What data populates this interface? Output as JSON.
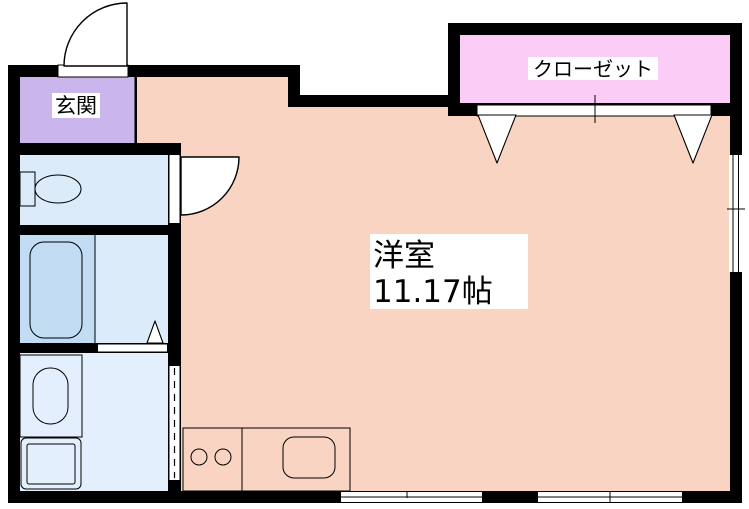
{
  "rooms": {
    "main": {
      "name_label": "洋室",
      "size_label": "11.17帖"
    },
    "entrance": {
      "label": "玄関"
    },
    "closet": {
      "label": "クローゼット"
    }
  },
  "colors": {
    "background": "#ffffff",
    "wall": "#000000",
    "main_room": "#f9d4c3",
    "entrance": "#cab5ec",
    "closet": "#fbcdf6",
    "wet_room": "#dcebfa",
    "wet_room_light": "#e3effc",
    "fixture_zone": "#c2dcf4",
    "fixture_cyan": "#b4eef6",
    "burner_brown": "#7a4210",
    "label_bg": "#ffffff"
  }
}
